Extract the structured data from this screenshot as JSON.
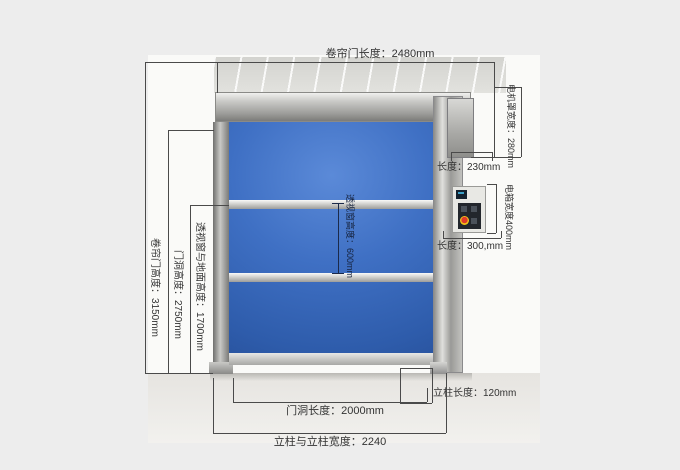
{
  "diagram": {
    "labels": {
      "door_width": "卷帘门长度：2480mm",
      "motor_cover_height": "电机罩宽度：280mm",
      "motor_cover_length": "长度：230mm",
      "control_box_height": "电箱宽度400mm",
      "control_box_length": "长度：300,mm",
      "door_height": "卷帘门高度：3150mm",
      "opening_height": "门洞高度：2750mm",
      "window_to_ground": "透视窗与地面高度：1700mm",
      "window_height": "透视窗高度：600mm",
      "opening_length": "门洞长度：2000mm",
      "column_length": "立柱长度：120mm",
      "column_to_column_width": "立柱与立柱宽度：2240"
    },
    "colors": {
      "curtain_blue": "#3f70c4",
      "frame_silver": "#b5b5b2",
      "background_gray": "#ededed",
      "dimension_line": "#4a4a4a"
    }
  }
}
